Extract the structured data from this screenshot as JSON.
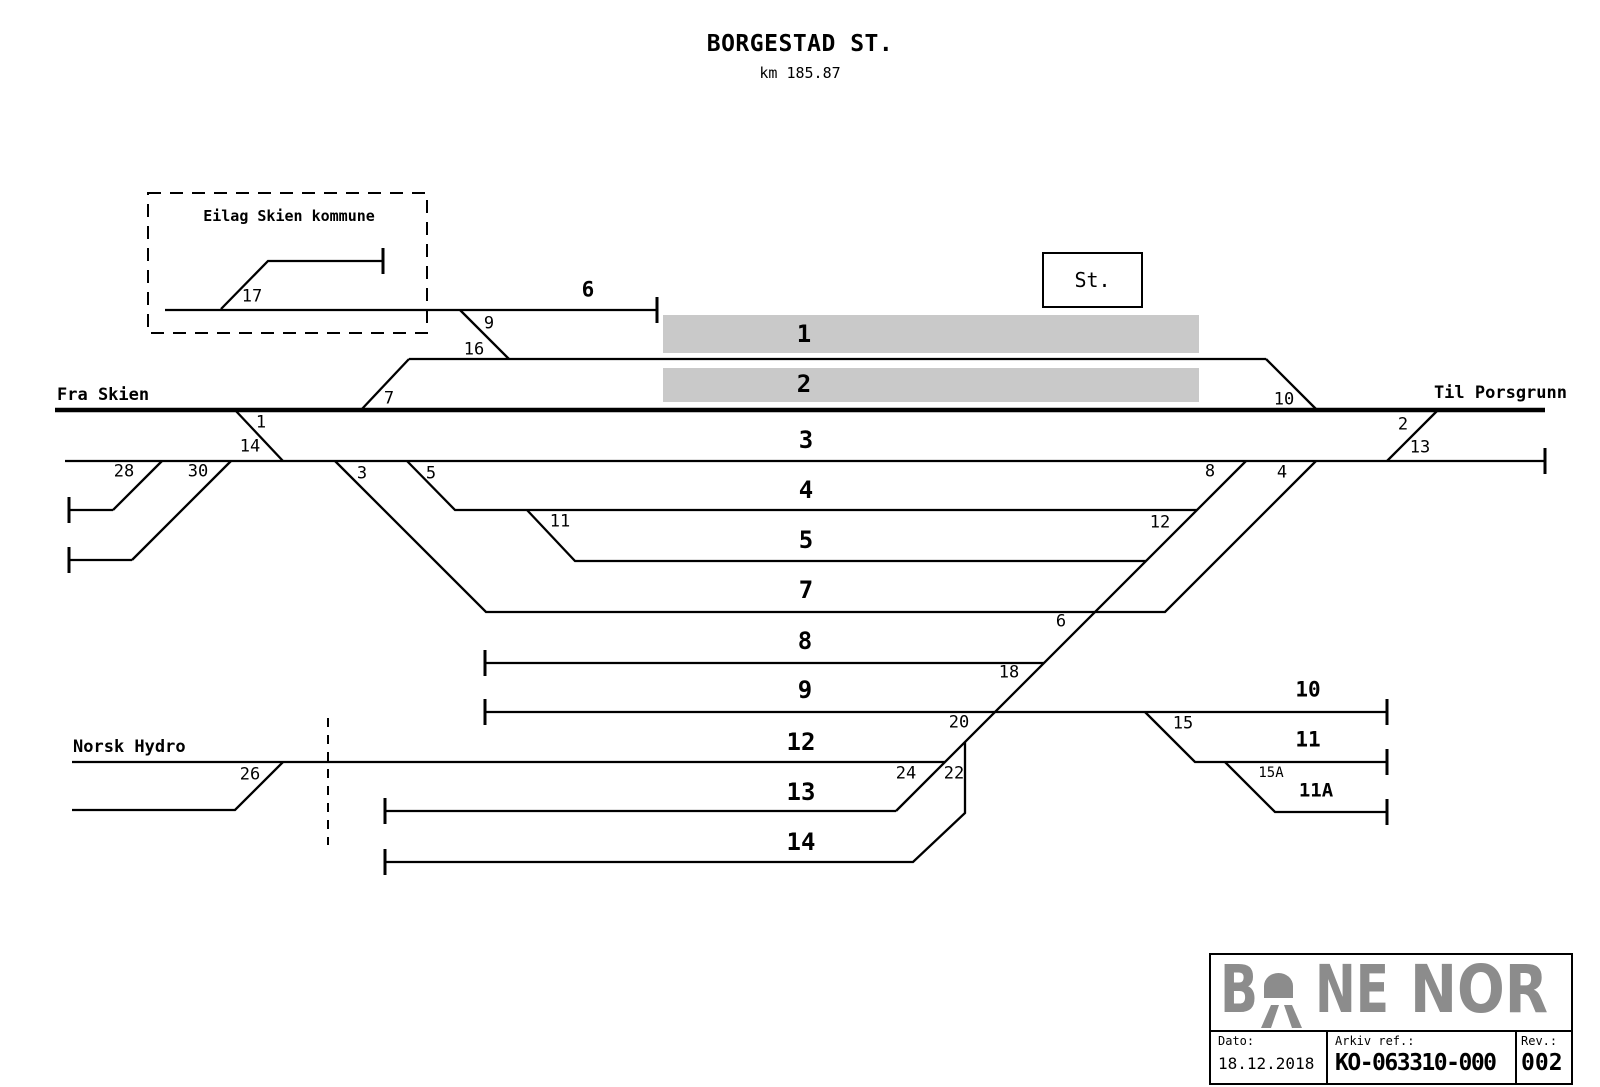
{
  "title": "BORGESTAD ST.",
  "subtitle": "km 185.87",
  "station_box_label": "St.",
  "enclosure_label": "Eilag Skien kommune",
  "endpoints": {
    "from": "Fra Skien",
    "to": "Til Porsgrunn",
    "siding_owner": "Norsk Hydro"
  },
  "colors": {
    "platform": "#c9c9c9",
    "logo_gray": "#8c8c8c",
    "line": "#000000"
  },
  "track_labels": [
    {
      "text": "1",
      "x": 804,
      "y": 334
    },
    {
      "text": "2",
      "x": 804,
      "y": 384
    },
    {
      "text": "3",
      "x": 806,
      "y": 440
    },
    {
      "text": "4",
      "x": 806,
      "y": 490
    },
    {
      "text": "5",
      "x": 806,
      "y": 540
    },
    {
      "text": "6",
      "x": 588,
      "y": 290,
      "size": 21
    },
    {
      "text": "7",
      "x": 806,
      "y": 590
    },
    {
      "text": "8",
      "x": 805,
      "y": 641
    },
    {
      "text": "9",
      "x": 805,
      "y": 690
    },
    {
      "text": "10",
      "x": 1308,
      "y": 690,
      "size": 21
    },
    {
      "text": "11",
      "x": 1308,
      "y": 740,
      "size": 21
    },
    {
      "text": "11A",
      "x": 1316,
      "y": 791,
      "size": 19
    },
    {
      "text": "12",
      "x": 801,
      "y": 742
    },
    {
      "text": "13",
      "x": 801,
      "y": 792
    },
    {
      "text": "14",
      "x": 801,
      "y": 842
    }
  ],
  "switch_labels": [
    {
      "text": "17",
      "x": 252,
      "y": 297
    },
    {
      "text": "9",
      "x": 489,
      "y": 324
    },
    {
      "text": "16",
      "x": 474,
      "y": 350
    },
    {
      "text": "7",
      "x": 389,
      "y": 399
    },
    {
      "text": "1",
      "x": 261,
      "y": 423
    },
    {
      "text": "14",
      "x": 250,
      "y": 447
    },
    {
      "text": "28",
      "x": 124,
      "y": 472
    },
    {
      "text": "30",
      "x": 198,
      "y": 472
    },
    {
      "text": "3",
      "x": 362,
      "y": 474
    },
    {
      "text": "5",
      "x": 431,
      "y": 474
    },
    {
      "text": "11",
      "x": 560,
      "y": 522
    },
    {
      "text": "12",
      "x": 1160,
      "y": 523
    },
    {
      "text": "8",
      "x": 1210,
      "y": 472
    },
    {
      "text": "4",
      "x": 1282,
      "y": 473
    },
    {
      "text": "10",
      "x": 1284,
      "y": 400
    },
    {
      "text": "2",
      "x": 1403,
      "y": 425
    },
    {
      "text": "13",
      "x": 1420,
      "y": 448
    },
    {
      "text": "6",
      "x": 1061,
      "y": 622
    },
    {
      "text": "18",
      "x": 1009,
      "y": 673
    },
    {
      "text": "20",
      "x": 959,
      "y": 723
    },
    {
      "text": "24",
      "x": 906,
      "y": 774
    },
    {
      "text": "22",
      "x": 954,
      "y": 774
    },
    {
      "text": "26",
      "x": 250,
      "y": 775
    },
    {
      "text": "15",
      "x": 1183,
      "y": 724
    },
    {
      "text": "15A",
      "x": 1271,
      "y": 773,
      "size": 14
    }
  ],
  "title_block": {
    "logo_text": "BANE NOR",
    "logo_parts": {
      "b": "B",
      "ne": "NE",
      "nor": "NOR"
    },
    "dato_label": "Dato:",
    "dato_value": "18.12.2018",
    "arkiv_label": "Arkiv ref.:",
    "arkiv_value": "KO-063310-000",
    "rev_label": "Rev.:",
    "rev_value": "002"
  }
}
